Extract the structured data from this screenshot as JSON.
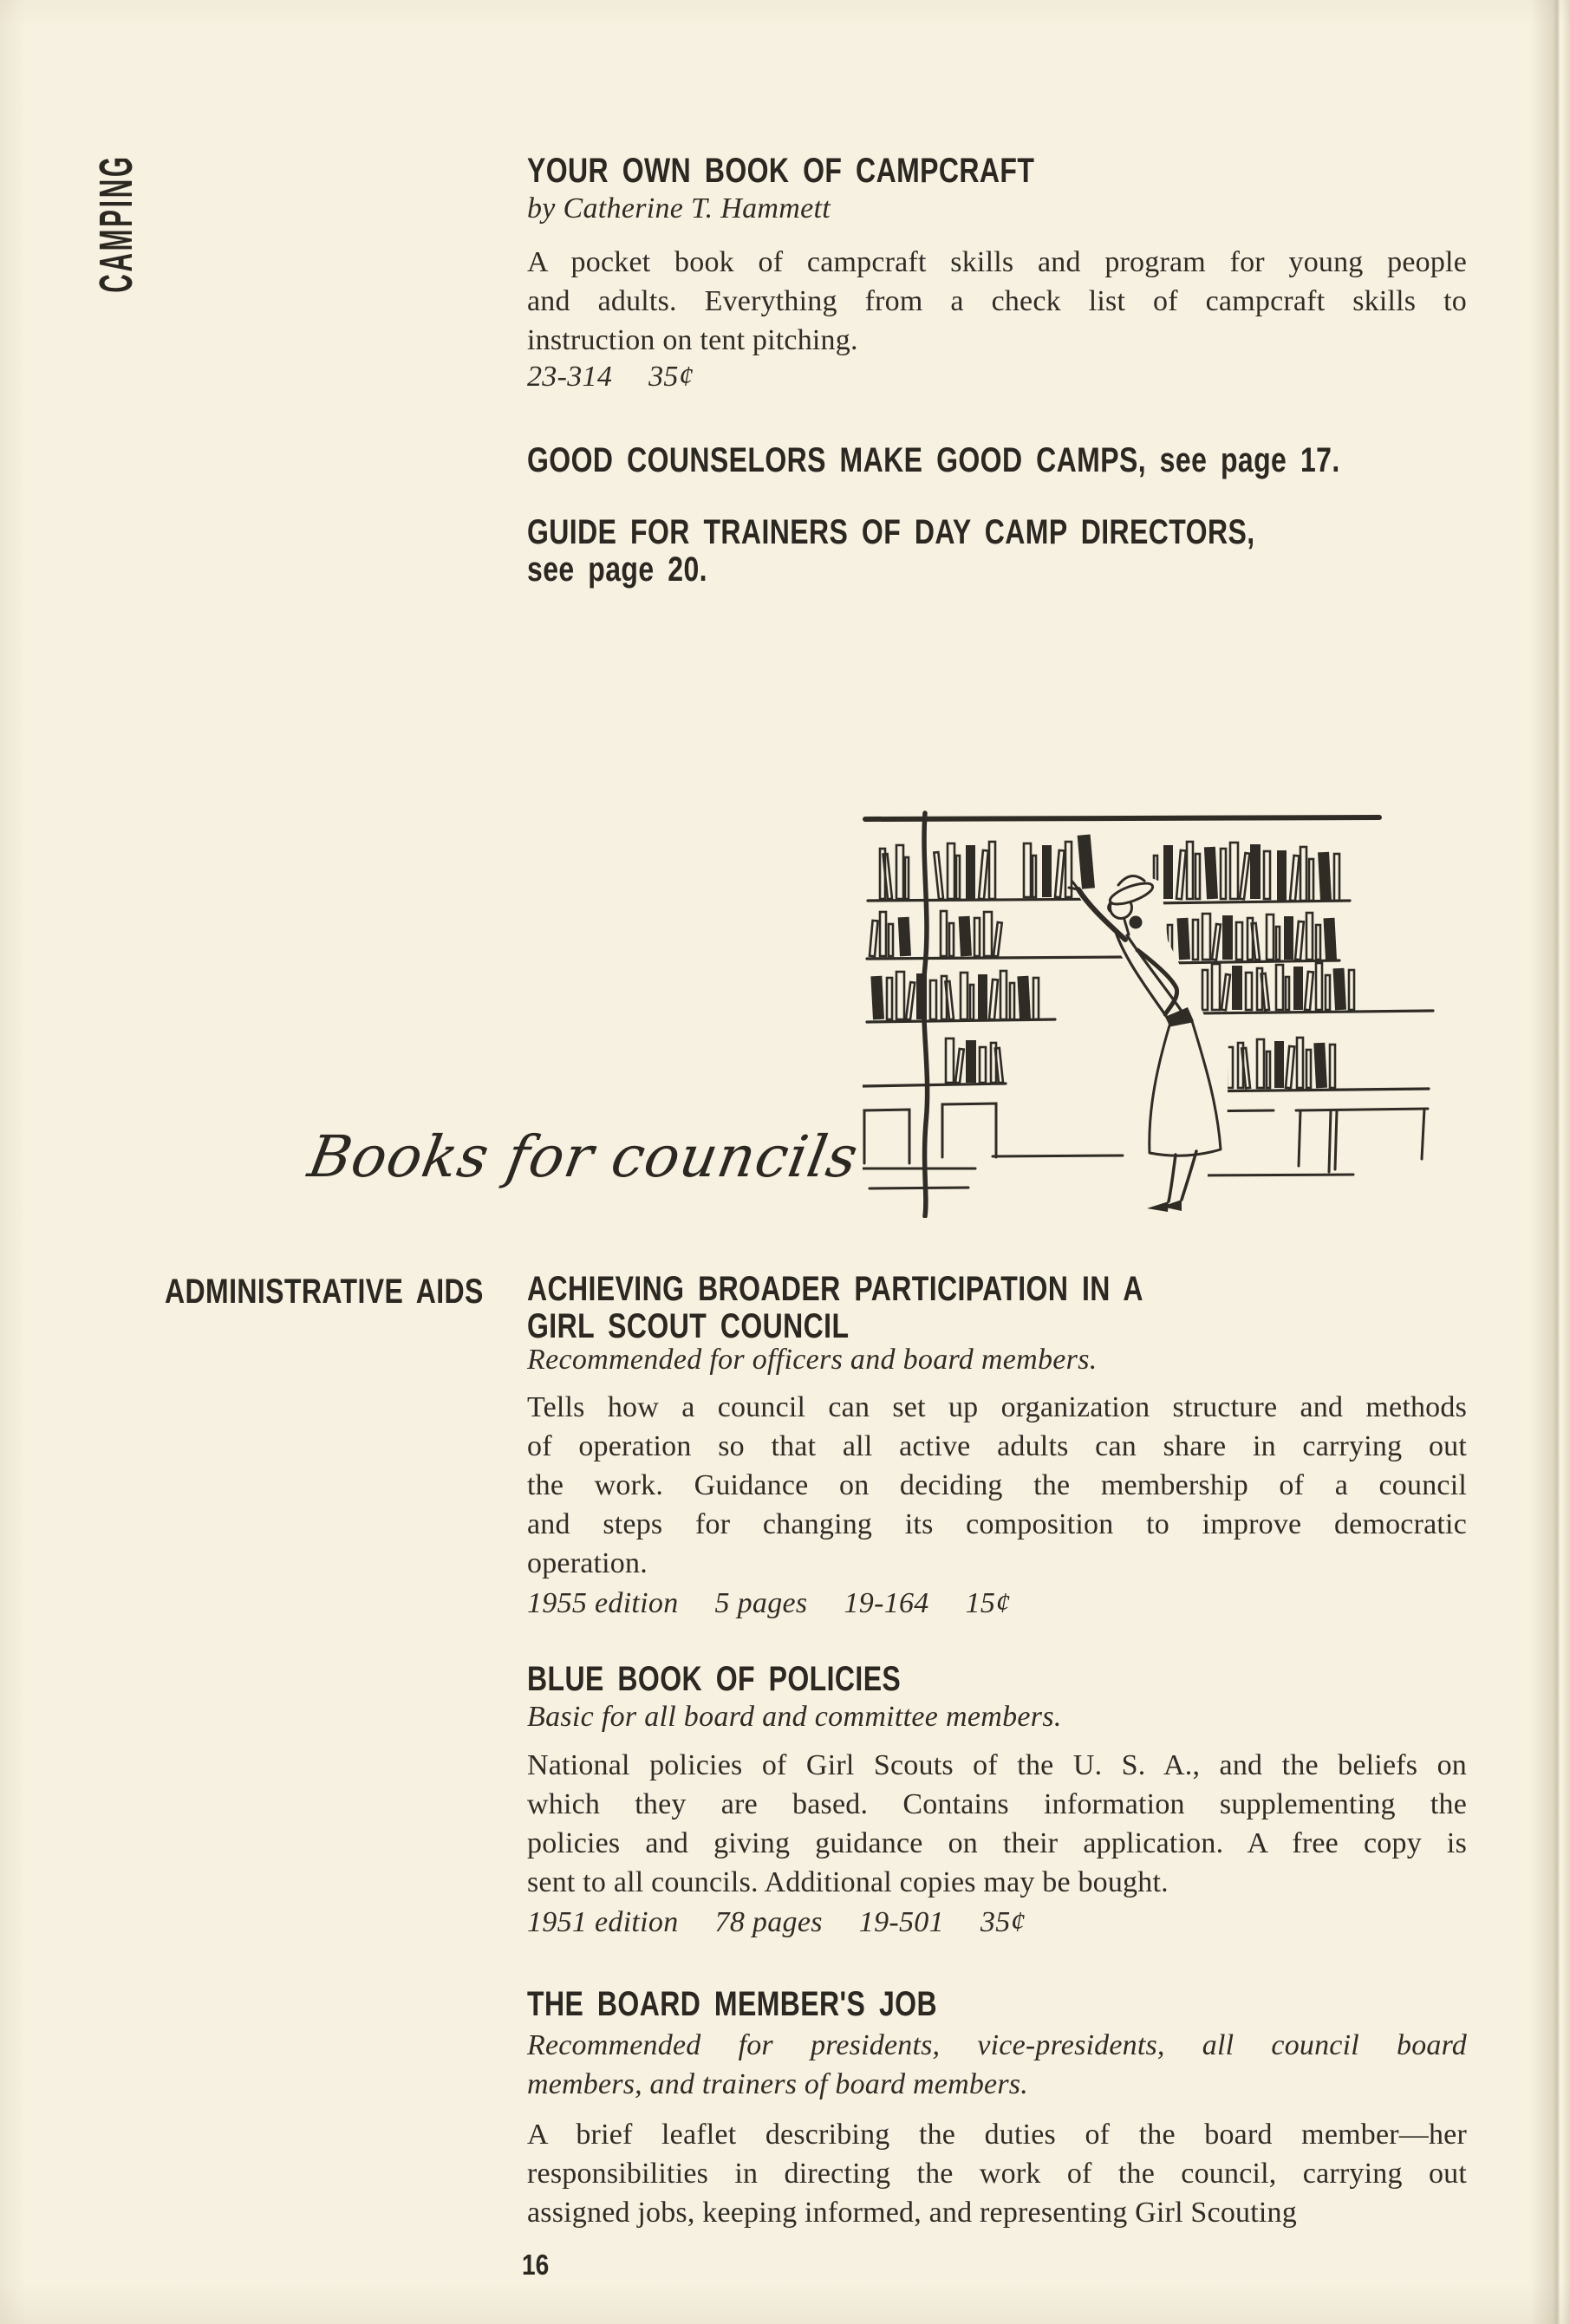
{
  "colors": {
    "paper": "#f6f1e0",
    "ink": "#2f2c26",
    "ink_heading": "#2b2822"
  },
  "page": {
    "sidebar_label": "CAMPING",
    "page_number": "16"
  },
  "camping_listings": [
    {
      "title_lines": [
        "YOUR OWN BOOK OF CAMPCRAFT"
      ],
      "byline": "by Catherine T. Hammett",
      "body_lines": [
        "A pocket book of campcraft skills and program for young people",
        "and adults. Everything from a check list of campcraft skills to",
        "instruction on tent pitching."
      ],
      "meta": [
        "23-314",
        "35¢"
      ]
    },
    {
      "title_lines": [
        "GOOD COUNSELORS MAKE GOOD CAMPS, see page 17."
      ]
    },
    {
      "title_lines": [
        "GUIDE FOR TRAINERS OF DAY CAMP DIRECTORS,",
        "see page 20."
      ]
    }
  ],
  "councils": {
    "script_heading": "Books for councils",
    "category_label": "ADMINISTRATIVE AIDS",
    "listings": [
      {
        "title_lines": [
          "ACHIEVING BROADER PARTICIPATION IN A",
          "GIRL SCOUT COUNCIL"
        ],
        "audience": "Recommended for officers and board members.",
        "body_lines": [
          "Tells how a council can set up organization structure and methods",
          "of operation so that all active adults can share in carrying out",
          "the work. Guidance on deciding the membership of a council",
          "and steps for changing its composition to improve democratic",
          "operation."
        ],
        "meta": [
          "1955 edition",
          "5 pages",
          "19-164",
          "15¢"
        ]
      },
      {
        "title_lines": [
          "BLUE BOOK OF POLICIES"
        ],
        "audience": "Basic for all board and committee members.",
        "body_lines": [
          "National policies of Girl Scouts of the U. S. A., and the beliefs on",
          "which they are based. Contains information supplementing the",
          "policies and giving guidance on their application. A free copy is",
          "sent to all councils. Additional copies may be bought."
        ],
        "meta": [
          "1951 edition",
          "78 pages",
          "19-501",
          "35¢"
        ]
      },
      {
        "title_lines": [
          "THE BOARD MEMBER'S JOB"
        ],
        "audience_lines": [
          "Recommended for presidents, vice-presidents, all council board",
          "members, and trainers of board members."
        ],
        "body_lines": [
          "A brief leaflet describing the duties of the board member—her",
          "responsibilities in directing the work of the council, carrying out",
          "assigned jobs, keeping informed, and representing Girl Scouting"
        ]
      }
    ]
  },
  "illustration": {
    "name": "woman-reaching-for-book-on-bookshelf"
  }
}
